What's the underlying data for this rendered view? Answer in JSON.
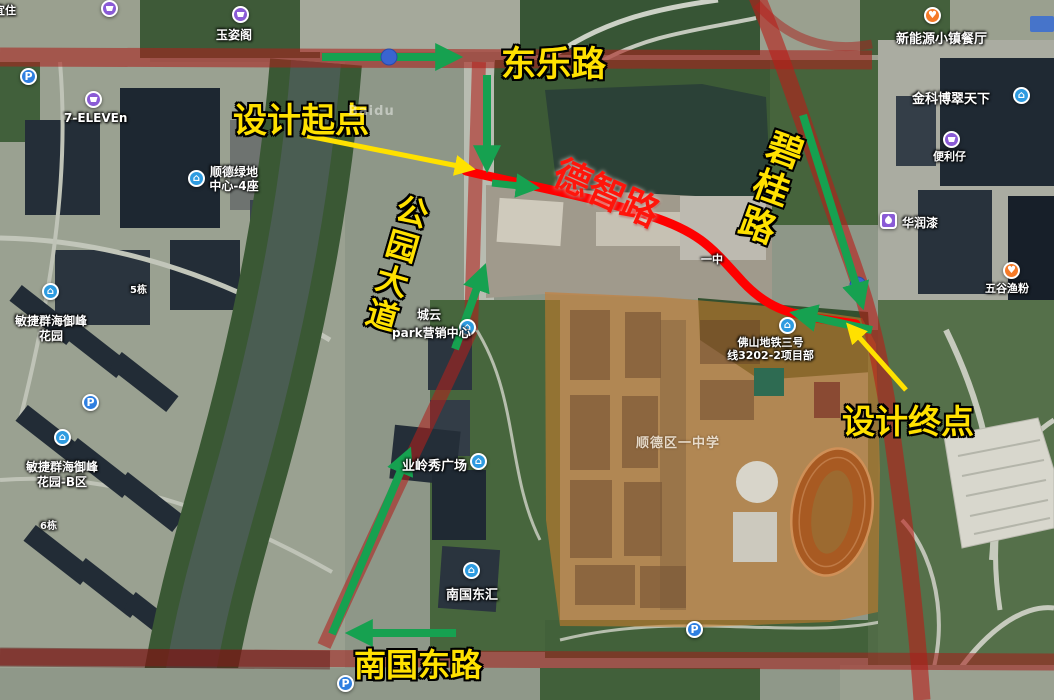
{
  "watermark": "Baidu",
  "labels": {
    "design_start": "设计起点",
    "design_end": "设计终点",
    "road_dongle": "东乐路",
    "road_dezhi": "德智路",
    "road_bigui": "碧桂路",
    "road_gongyuan": "公园大道",
    "road_nanguo": "南国东路"
  },
  "pois": {
    "yizhu": "宜住",
    "yuzige": "玉姿阁",
    "seven_eleven": "7-ELEVEn",
    "greenland_l1": "顺德绿地",
    "greenland_l2": "中心-4座",
    "minjie_l1": "敏捷群海御峰",
    "minjie_l2": "花园",
    "minjie_b_l1": "敏捷群海御峰",
    "minjie_b_l2": "花园-B区",
    "dong5": "5栋",
    "dong6": "6栋",
    "chengyun_l1": "城云",
    "chengyun_l2": "park营销中心",
    "yelingxiu": "业岭秀广场",
    "nanguodonghui": "南国东汇",
    "metro_l1": "佛山地铁三号",
    "metro_l2": "线3202-2项目部",
    "xinnengyuan": "新能源小镇餐厅",
    "jinke": "金科博翠天下",
    "bianlizai": "便利仔",
    "huarun": "华润漆",
    "wugu": "五谷渔粉",
    "yizhong": "一中",
    "school": "顺德区一中学"
  },
  "icons": {
    "parking_glyph": "P",
    "building_glyph": "⌂",
    "food_glyph": "♥"
  },
  "colors": {
    "annotation_yellow": "#ffe100",
    "route_red": "#ff0000",
    "arrow_green": "#16a150",
    "road_overlay_red": "#aa201c",
    "school_overlay_orange": "#cd7d2e"
  }
}
